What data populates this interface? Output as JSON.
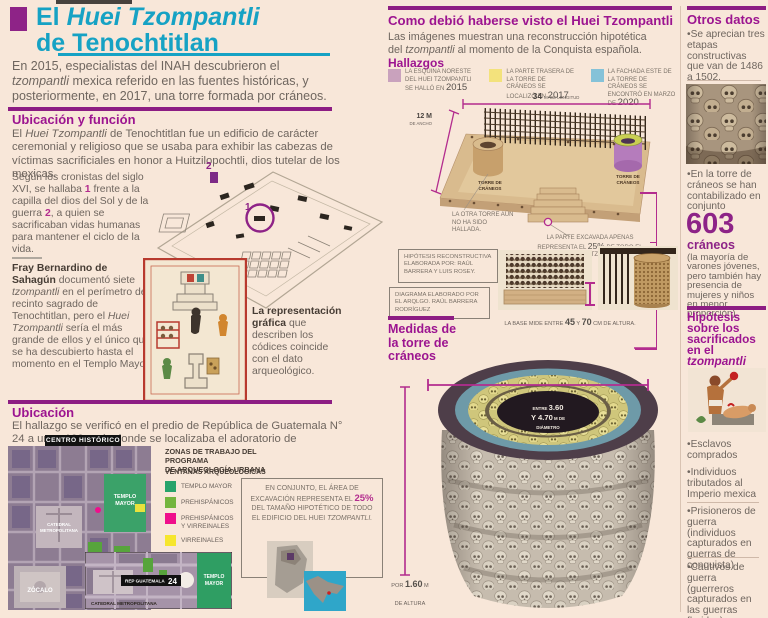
{
  "left": {
    "title": {
      "pre": "El ",
      "italic": "Huei Tzompantli",
      "line2": "de Tenochtitlan"
    },
    "intro_parts": {
      "p1": "En 2015, especialistas del INAH descubrieron el ",
      "i1": "tzompantli",
      "p2": " mexica referido en las fuentes históricas, y posteriormente, en 2017, una torre formada por cráneos."
    },
    "ubicacion_funcion": {
      "heading": "Ubicación y función",
      "body_parts": {
        "p1": "El ",
        "i1": "Huei Tzompantli",
        "p2": " de Tenochtitlan fue un edificio de carácter ceremonial y religioso que se usaba para exhibir las cabezas de víctimas sacrificiales en honor a Huitzilopochtli, dios tutelar de los mexicas."
      }
    },
    "cronistas_parts": {
      "p1": "Según los cronistas del siglo XVI, se hallaba ",
      "n1": "1",
      "p2": " frente a la capilla del dios del Sol y de la guerra ",
      "n2": "2",
      "p3": ", a quien se sacrificaban vidas humanas para mantener el ciclo de la vida."
    },
    "sahagun_parts": {
      "b1": "Fray Bernardino de Sahagún",
      "p1": " documentó siete ",
      "i1": "tzompantli",
      "p2": " en el perímetro del recinto sagrado de Tenochtitlan, pero el ",
      "i2": "Huei Tzompantli",
      "p3": " sería el más grande de ellos y el único que se ha descubierto hasta el momento en el Templo Mayor."
    },
    "codices_parts": {
      "b1": "La representación gráfica",
      "p1": " que describen los códices coincide con el dato arqueológico."
    },
    "precinct": {
      "marker1": "1",
      "marker2": "2"
    },
    "ubicacion": {
      "heading": "Ubicación",
      "body": "El hallazgo se verificó en el predio de República de Guatemala N° 24 a unos 100 m de donde se localizaba el adoratorio de Huitzilopochtli."
    },
    "map": {
      "area_label": "CENTRO HISTÓRICO",
      "templo_l1": "TEMPLO",
      "templo_l2": "MAYOR",
      "catedral_l1": "CATEDRAL",
      "catedral_l2": "METROPOLITANA",
      "zocalo": "ZÓCALO",
      "legend_title_l1": "ZONAS DE TRABAJO DEL PROGRAMA",
      "legend_title_l2": "DE ARQUEOLOGÍA URBANA",
      "legend_subtitle": "VENTANAS ARQUEOLÓGICAS",
      "legend_items": [
        {
          "label": "TEMPLO MAYOR",
          "color": "#27a36b"
        },
        {
          "label": "PREHISPÁNICOS",
          "color": "#74b53e"
        },
        {
          "label": "PREHISPÁNICOS Y VIRREINALES",
          "color": "#ef0f8b"
        },
        {
          "label": "VIRREINALES",
          "color": "#f6e62e"
        }
      ],
      "note_parts": {
        "p1": "EN CONJUNTO, EL ÁREA DE EXCAVACIÓN REPRESENTA EL ",
        "pct": "25%",
        "p2": " DEL TAMAÑO HIPOTÉTICO DE TODO EL EDIFICIO DEL HUEI ",
        "i1": "TZOMPANTLI."
      },
      "inset": {
        "rep": "REP GUATEMALA",
        "rep_num": "24",
        "catedral": "CATEDRAL METROPOLITANA"
      }
    }
  },
  "middle": {
    "heading": "Como debió haberse visto el Huei Tzompantli",
    "intro_parts": {
      "p1": "Las imágenes muestran una reconstrucción hipotética del ",
      "i1": "tzompantli",
      "p2": " al momento de la Conquista española."
    },
    "hallazgos_heading": "Hallazgos",
    "hallazgos": [
      {
        "color": "#c9a2bd",
        "text": "LA ESQUINA NORESTE DEL HUEI TZOMPANTLI SE HALLÓ EN ",
        "year": "2015"
      },
      {
        "color": "#f3e27c",
        "text": "LA PARTE TRASERA DE LA TORRE DE CRÁNEOS SE LOCALIZÓ EN ",
        "year": "2017"
      },
      {
        "color": "#85c2d8",
        "text": "LA FACHADA ESTE DE LA TORRE DE CRÁNEOS SE ENCONTRÓ EN MARZO DE ",
        "year": "2020"
      }
    ],
    "dims": {
      "length_num": "34",
      "length_label": "M. DE LONGITUD",
      "width_num": "12 M",
      "width_label": "DE ANCHO"
    },
    "tower_l1": "TORRE DE",
    "tower_l2": "CRÁNEOS",
    "note_other_tower": "LA OTRA TORRE AÚN NO HA SIDO HALLADA.",
    "note_excavated_parts": {
      "p1": "LA PARTE EXCAVADA APENAS REPRESENTA EL ",
      "pct": "25%",
      "p2": " DE TODO EL EDIFICIO DEL TZOMPANTLI."
    },
    "credit_hypothesis": "HIPÓTESIS RECONSTRUCTIVA ELABORADA POR: RAÚL BARRERA Y LUIS ROSEY.",
    "credit_diagram": "DIAGRAMA ELABORADO POR EL ARQLGO. RAÚL BARRERA RODRÍGUEZ",
    "base_caption_parts": {
      "p1": "LA BASE MIDE ENTRE ",
      "n1": "45",
      "p2": " Y ",
      "n2": "70",
      "p3": " CM DE ALTURA."
    },
    "medidas_heading_l1": "Medidas de",
    "medidas_heading_l2": "la torre de",
    "medidas_heading_l3": "cráneos",
    "diameter_parts": {
      "s1": "ENTRE ",
      "n1": "3.60",
      "s2": "Y ",
      "n2": "4.70",
      "s3": " M DE",
      "s4": "DIÁMETRO"
    },
    "height_parts": {
      "p1": "POR ",
      "n1": "1.60",
      "p2": " M",
      "l2": "DE ALTURA"
    }
  },
  "right": {
    "otros_heading": "Otros datos",
    "fact1": "•Se aprecian tres etapas constructivas que van de 1486 a 1502.",
    "fact2": "•En la torre de cráneos se han contabilizado en conjunto",
    "count_number": "603",
    "count_unit": "cráneos",
    "count_note": "(la mayoría de varones jóvenes, pero también hay presencia de mujeres y niños en menor proporción).",
    "hipotesis_heading_main": "Hipótesis sobre los sacrificados en el ",
    "hipotesis_heading_italic": "tzompantli",
    "bullets": [
      "•Esclavos comprados",
      "•Individuos tributados al Imperio mexica",
      "•Prisioneros de guerra (individuos capturados en guerras de conquista)",
      "•Cautivos de guerra (guerreros capturados en las guerras floridas)"
    ]
  },
  "colors": {
    "accent_teal": "#16a2c4",
    "accent_magenta": "#9c1490",
    "dimension_magenta": "#b32c8e",
    "body_text": "#6f665f"
  }
}
